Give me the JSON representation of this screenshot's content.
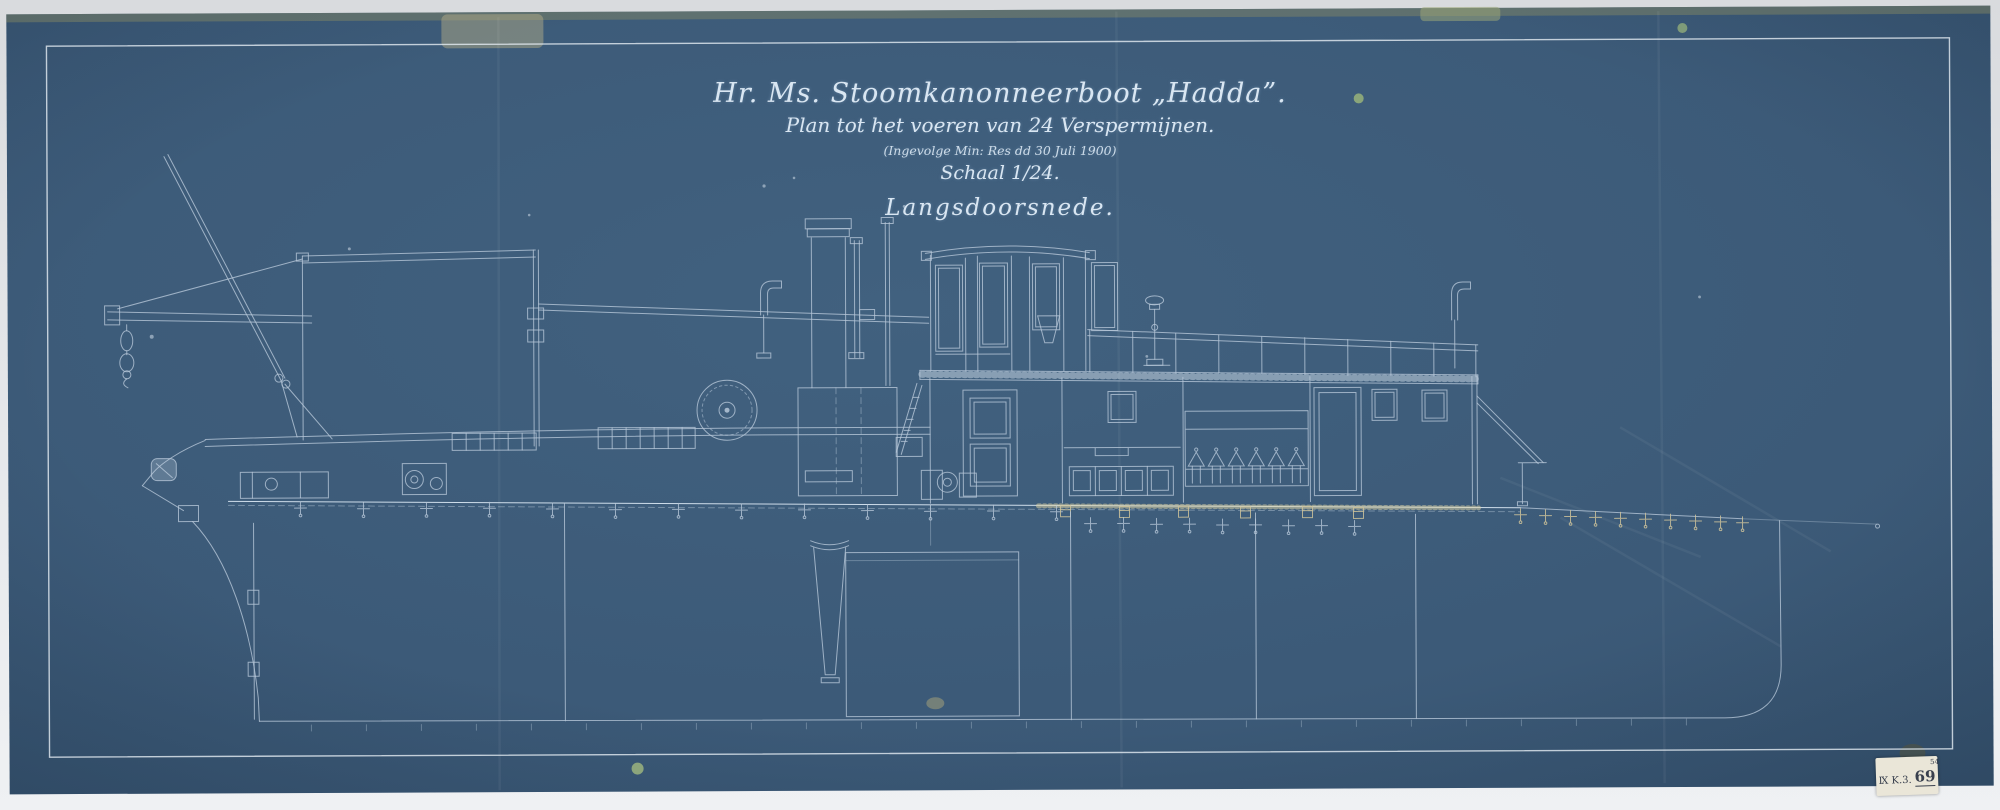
{
  "title_block": {
    "line1": "Hr. Ms. Stoomkanonneerboot „Hadda”.",
    "line2": "Plan tot het voeren van 24 Verspermijnen.",
    "line3": "(Ingevolge Min: Res dd 30 Juli 1900)",
    "line4": "Schaal 1/24.",
    "line5": "Langsdoorsnede."
  },
  "archive_label": {
    "series": "Ⅸ K.3.",
    "superscript": "54",
    "number": "69"
  },
  "colors": {
    "paper_blue": "#3c5a78",
    "line_white": "#b6c7d8",
    "bright_line": "#d6e4f0",
    "aged_tan": "#cdc29a",
    "backing_gray": "#e7e9ec",
    "label_cream": "#eae6d8",
    "label_ink": "#39404e",
    "tape_olive": "#8f8f62"
  }
}
